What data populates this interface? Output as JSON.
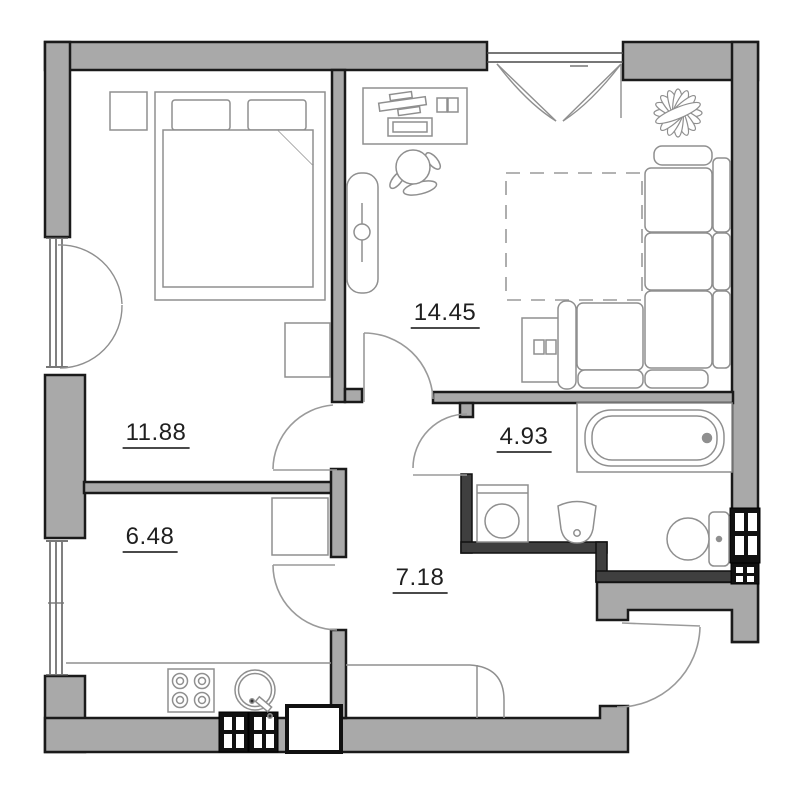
{
  "document": {
    "type": "apartment-floor-plan"
  },
  "rooms": [
    {
      "id": "bedroom",
      "area_label": "11.88"
    },
    {
      "id": "living-room",
      "area_label": "14.45"
    },
    {
      "id": "bathroom",
      "area_label": "4.93"
    },
    {
      "id": "kitchen",
      "area_label": "6.48"
    },
    {
      "id": "hallway",
      "area_label": "7.18"
    }
  ],
  "symbols": [
    "bed",
    "pillow",
    "blanket",
    "nightstand",
    "dresser",
    "desk",
    "laptop",
    "monitor",
    "office-chair",
    "wardrobe",
    "plant",
    "corner-sofa",
    "rug",
    "tv-stand",
    "bathtub",
    "washing-machine",
    "washbasin",
    "toilet",
    "ventilation-shaft",
    "stove",
    "kitchen-sink",
    "kitchen-counter",
    "hallway-cabinet",
    "window",
    "door-swing",
    "entrance-door",
    "balcony-door"
  ],
  "colors": {
    "background": "#ffffff",
    "wall_fill": "#a9a9a9",
    "wall_outline": "#1a1a1a",
    "partition_fill": "#3f3f3f",
    "furniture_line": "#8f8f8f",
    "door_line": "#9a9a9a",
    "label_text": "#1f1f1f",
    "label_underline": "#4a4a4a"
  }
}
